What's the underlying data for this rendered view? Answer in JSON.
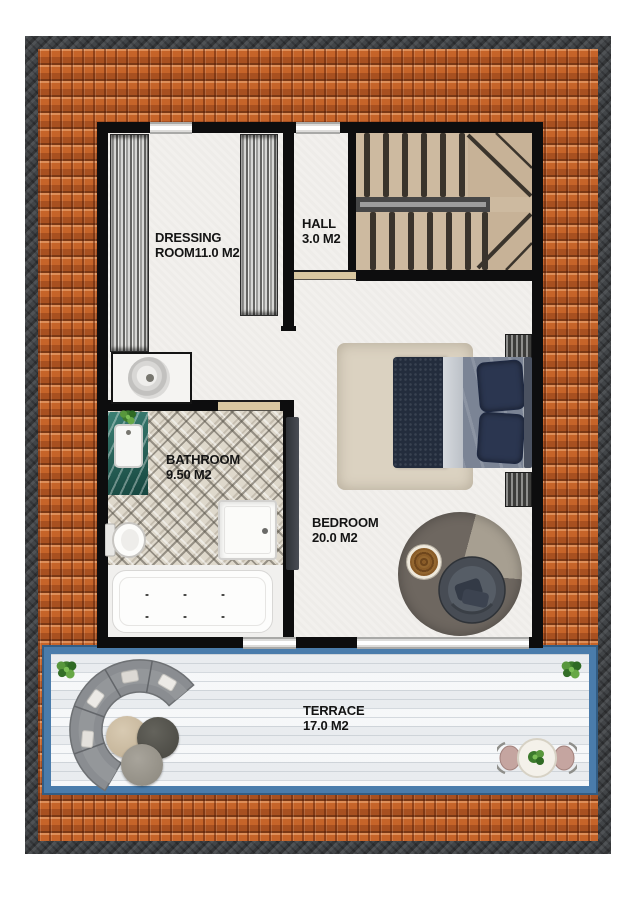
{
  "plan_title": "apartment-upper-floor-plan",
  "rooms": {
    "dressing": {
      "line1": "DRESSING",
      "line2": "ROOM11.0 M2"
    },
    "hall": {
      "line1": "HALL",
      "line2": "3.0 M2"
    },
    "bathroom": {
      "line1": "BATHROOM",
      "line2": "9.50 M2"
    },
    "bedroom": {
      "line1": "BEDROOM",
      "line2": "20.0 M2"
    },
    "terrace": {
      "line1": "TERRACE",
      "line2": "17.0 M2"
    }
  },
  "colors": {
    "roof_tile": "#c66429",
    "outer_frame": "#3c3f42",
    "wall": "#0d0d0e",
    "terrace_rail_blue": "#4a7cab",
    "floor": "#f2f0ed",
    "stair_wood": "#cdbaa0",
    "bed_duvet_navy": "#232c3c",
    "sofa_gray": "#8a8d91",
    "vanity_teal": "#2c6a60",
    "label_text": "#141414"
  }
}
